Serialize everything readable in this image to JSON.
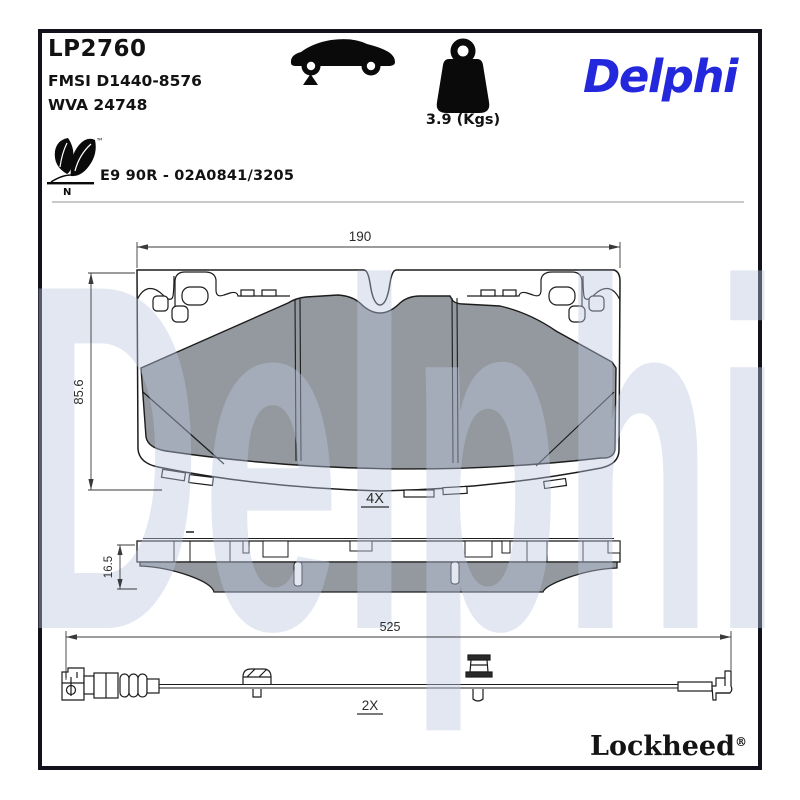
{
  "product": {
    "part_number": "LP2760",
    "fmsi_code": "FMSI D1440-8576",
    "wva_code": "WVA 24748",
    "weight": "3.9 (Kgs)",
    "approval_code": "E9 90R - 02A0841/3205",
    "eco_mark_letter": "N",
    "trademark_symbol": "™"
  },
  "brand": {
    "logo_text": "Delphi",
    "watermark_text": "Delphi",
    "footer_brand": "Lockheed",
    "registered_symbol": "®",
    "logo_color": "#2428DD",
    "watermark_color": "#b9c6e0"
  },
  "icons": {
    "car": "car-side-silhouette",
    "weight": "kettlebell-weight",
    "eco": "leaf-eco-mark"
  },
  "dimensions": {
    "pad_width": "190",
    "pad_height": "85.6",
    "pad_thickness": "16.5",
    "sensor_length": "525",
    "pad_quantity": "4X",
    "sensor_quantity": "2X"
  },
  "colors": {
    "friction_material": "#8e939a",
    "outline": "#1c1c1c",
    "frame": "#12121c"
  }
}
